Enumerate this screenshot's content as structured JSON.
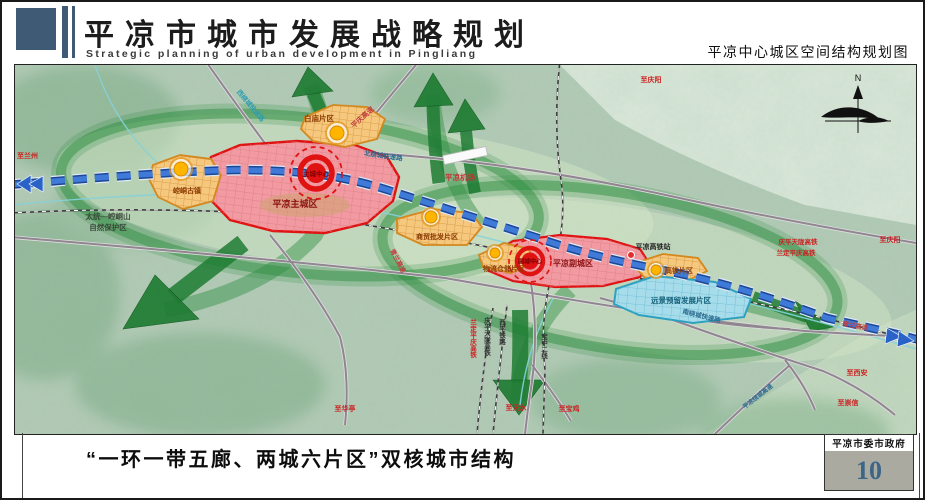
{
  "header": {
    "title": "平凉市城市发展战略规划",
    "subtitle": "Strategic planning of urban development in Pingliang",
    "map_title": "平凉中心城区空间结构规划图"
  },
  "map": {
    "zones": {
      "main_city": "平凉主城区",
      "main_center": "主城中心",
      "sub_city": "平凉副城区",
      "sub_center": "副城中心",
      "baimiao": "白庙片区",
      "kongtong": "崆峒古镇",
      "trade": "商贸批发片区",
      "logistics": "物流仓储片区",
      "hsr_district": "高铁片区",
      "reserved": "远景预留发展片区"
    },
    "features": {
      "airport": "平凉机场",
      "hsr_station": "平凉高铁站",
      "nature_reserve_line1": "太统—崆峒山",
      "nature_reserve_line2": "自然保护区",
      "compass_north": "N"
    },
    "roads": {
      "pingqing_expwy": "平庆高速",
      "qinglan_expwy": "青兰高速",
      "qinglan_expwy_east": "青兰高速",
      "north_ring": "北绕城快速路",
      "south_ring": "南绕城快速路",
      "west_ring": "西绕城快速路",
      "city_ring": "平凉绕城高速"
    },
    "railways": {
      "qptl_hsr": "庆平天陇高铁",
      "ldpq_hsr": "兰定平庆高铁",
      "qptl_hsr_v": "庆平天陇高铁",
      "ldpq_hsr_v": "兰定平庆高铁",
      "xiping_rail": "西平铁路",
      "baozhong_rail": "宝中二线"
    },
    "directions": {
      "to_lanzhou": "至兰州",
      "to_qingyang_top": "至庆阳",
      "to_qingyang_right": "至庆阳",
      "to_xian": "至西安",
      "to_chongxin": "至崇信",
      "to_huating": "至华亭",
      "to_tianshui": "至天水",
      "to_baoji": "至宝鸡"
    }
  },
  "footer": {
    "caption": "“一环一带五廊、两城六片区”双核城市结构",
    "agency": "平凉市委市政府",
    "page_number": "10"
  },
  "colors": {
    "accent_blue": "#3e5a74",
    "zone_red": "#e01313",
    "zone_orange": "#d4871c",
    "zone_blue": "#2da0c0",
    "corridor_green": "#1f7c33",
    "belt_blue": "#3f7ad8"
  }
}
